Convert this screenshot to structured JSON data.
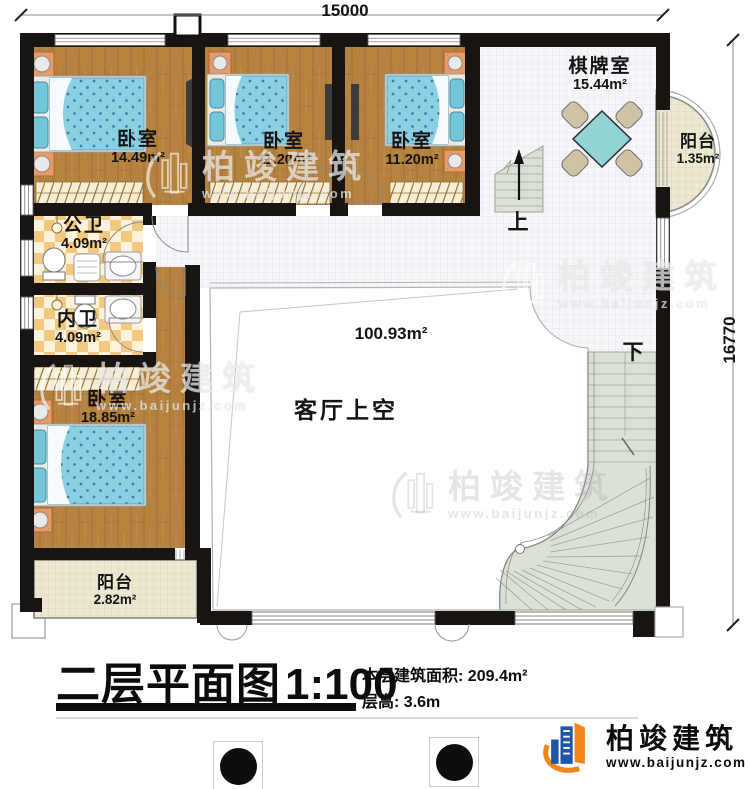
{
  "plan": {
    "dimensions": {
      "top": "15000",
      "right": "16770"
    },
    "rooms": {
      "bedroom_top_left": {
        "name": "卧室",
        "area": "14.49m²"
      },
      "bedroom_top_mid": {
        "name": "卧室",
        "area": "11.20m²"
      },
      "bedroom_top_right": {
        "name": "卧室",
        "area": "11.20m²"
      },
      "chess_room": {
        "name": "棋牌室",
        "area": "15.44m²"
      },
      "balcony_right": {
        "name": "阳台",
        "area": "1.35m²"
      },
      "public_bath": {
        "name": "公卫",
        "area": "4.09m²"
      },
      "inner_bath": {
        "name": "内卫",
        "area": "4.09m²"
      },
      "bedroom_large": {
        "name": "卧室",
        "area": "18.85m²"
      },
      "balcony_bottom": {
        "name": "阳台",
        "area": "2.82m²"
      },
      "living_void": {
        "name": "客厅上空",
        "area": "100.93m²"
      }
    },
    "stairs": {
      "up": "上",
      "down": "下"
    }
  },
  "title_block": {
    "title": "二层平面图",
    "scale": "1:100",
    "area_label": "本层建筑面积:",
    "area_value": "209.4m²",
    "height_label": "层高:",
    "height_value": "3.6m"
  },
  "brand": {
    "company": "柏竣建筑",
    "website": "www.baijunjz.com"
  },
  "watermark": {
    "company": "柏竣建筑",
    "website": "www.baijunjz.com"
  },
  "colors": {
    "wall": "#171412",
    "wood": "#b5823f",
    "bed": "#8bcfe2",
    "tile_light": "#fdf3da",
    "tile_dark": "#f3c981",
    "floor_grid": "#f7f7fa",
    "balcony": "#ece8d1",
    "stair": "#dce1d7",
    "table": "#92d4d6",
    "logo_blue": "#1f56a5",
    "logo_orange": "#f08519"
  }
}
